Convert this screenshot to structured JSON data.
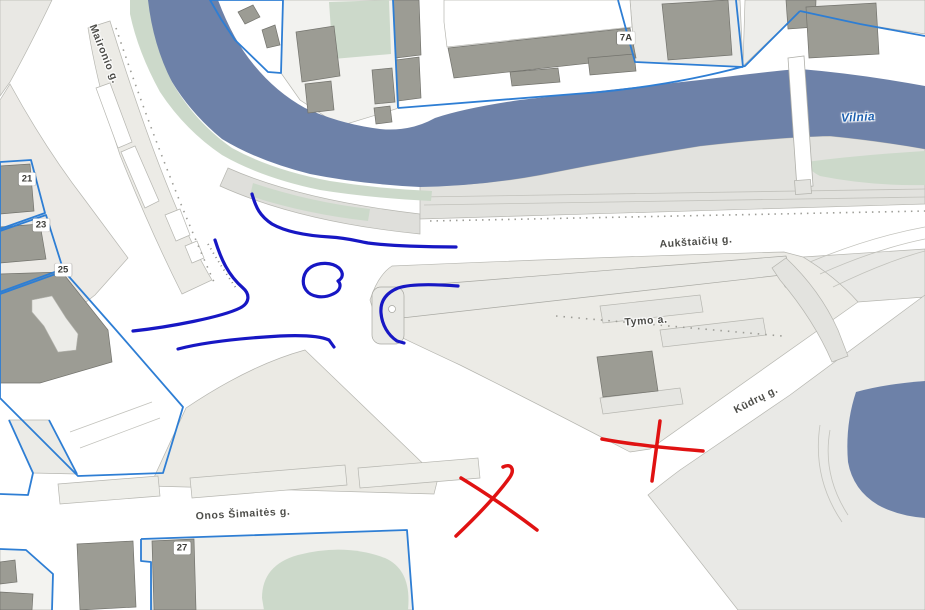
{
  "map": {
    "street_labels": {
      "maironio": {
        "text": "Maironio g."
      },
      "aukstaiciu": {
        "text": "Aukštaičių g."
      },
      "tymo": {
        "text": "Tymo a."
      },
      "kudru": {
        "text": "Kūdrų g."
      },
      "onos": {
        "text": "Onos Šimaitės g."
      }
    },
    "water_labels": {
      "river": {
        "text": "Vilnia"
      }
    },
    "building_numbers": {
      "b21": {
        "text": "21"
      },
      "b23": {
        "text": "23"
      },
      "b25": {
        "text": "25"
      },
      "b27": {
        "text": "27"
      },
      "b7a": {
        "text": "7A"
      }
    },
    "colors": {
      "water": "#6d81a8",
      "green": "#ccd9ca",
      "building": "#9c9c94",
      "building_edge": "#73736d",
      "parcel_line": "#2e7ed4",
      "block_fill": "#e9e8e4",
      "annotation_blue": "#1717c4",
      "annotation_red": "#e01212",
      "street_label_text": "#4c4c48",
      "water_label_text": "#1d5fae"
    },
    "annotations": {
      "blue_paths": [
        "M252,194 C256,208 260,216 272,224 C288,233 312,236 330,237 C348,238 356,241 368,243 C390,246 430,247 456,247",
        "M215,240 C221,259 228,275 243,288 C250,294 250,303 240,308 C222,317 170,327 133,331",
        "M311,267 C319,262 332,262 339,268 C344,273 343,278 338,281 C342,285 340,291 333,294 C323,299 311,297 306,290 C301,283 303,272 311,267 Z",
        "M178,349 C205,342 245,338 280,336 C302,335 320,336 329,340 L334,347",
        "M458,286 C432,284 410,284 398,288 C386,293 380,301 381,313 C382,325 388,335 397,341 L404,343"
      ],
      "red_paths": [
        "M503,467 C511,463 515,469 510,477 C498,494 477,516 456,536",
        "M461,478 C484,492 515,513 537,530",
        "M602,439 C628,444 665,448 703,451",
        "M660,421 C658,437 655,458 652,481"
      ]
    }
  }
}
